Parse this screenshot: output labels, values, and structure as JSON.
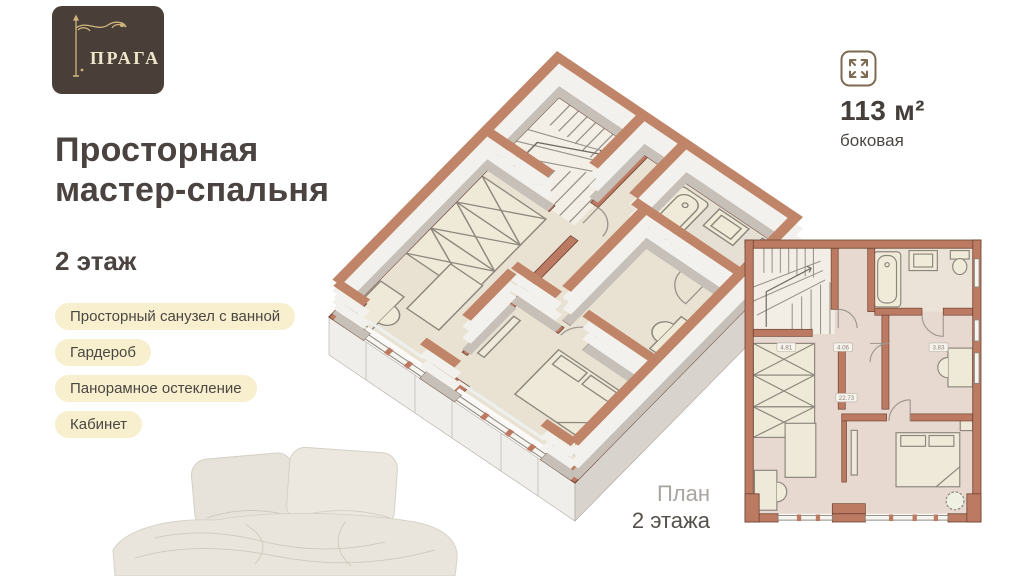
{
  "brand": {
    "name": "ПРАГА"
  },
  "headline": {
    "line1": "Просторная",
    "line2": "мастер-спальня"
  },
  "floor_label": "2 этаж",
  "features": [
    "Просторный санузел с ванной",
    "Гардероб",
    "Панорамное остекление",
    "Кабинет"
  ],
  "area_badge": {
    "value": "113 м²",
    "subtitle": "боковая"
  },
  "plan_caption": {
    "line1": "План",
    "line2": "2 этажа"
  },
  "plan_2d": {
    "area_labels": [
      "4.81",
      "4.06",
      "3.83",
      "22.73"
    ]
  },
  "colors": {
    "terracotta": "#bd7a62",
    "logo_bg": "#4a3e38",
    "pill_bg": "#f7efce",
    "text_dark": "#4a4340",
    "gold": "#cdb67e"
  }
}
